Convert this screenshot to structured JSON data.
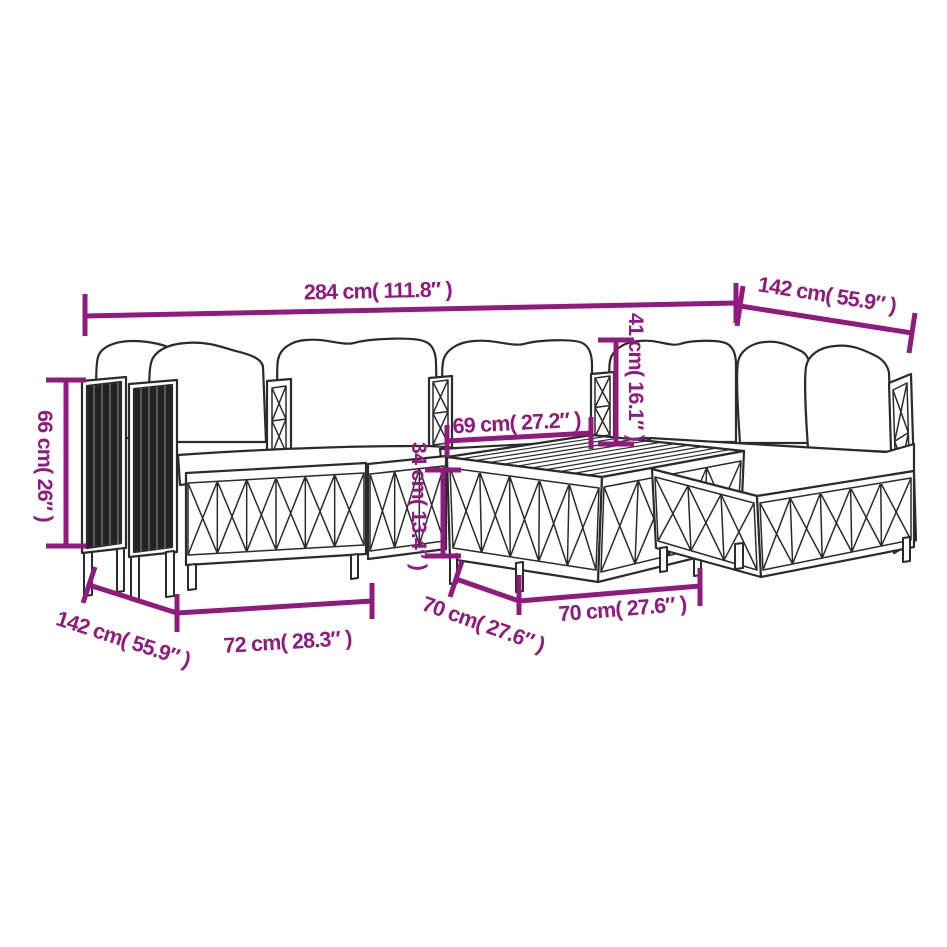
{
  "diagram": {
    "type": "product-dimension-diagram",
    "subject": "7 piece garden lounge set with cushions - line drawing",
    "accent_color": "#901A7D",
    "line_color": "#2B2B2B",
    "background_color": "#FFFFFF",
    "dimensions": {
      "overall_width": "284 cm( 111.8″ )",
      "overall_depth": "142 cm( 55.9″ )",
      "overall_height": "66 cm( 26″ )",
      "backrest_height": "41 cm( 16.1″ )",
      "seat_inner_width": "69 cm( 27.2″ )",
      "table_height": "34 cm( 13.4″ )",
      "left_section_depth": "142 cm( 55.9″ )",
      "seat_width": "72 cm( 28.3″ )",
      "table_depth": "70 cm( 27.6″ )",
      "table_width": "70 cm( 27.6″ )"
    }
  }
}
